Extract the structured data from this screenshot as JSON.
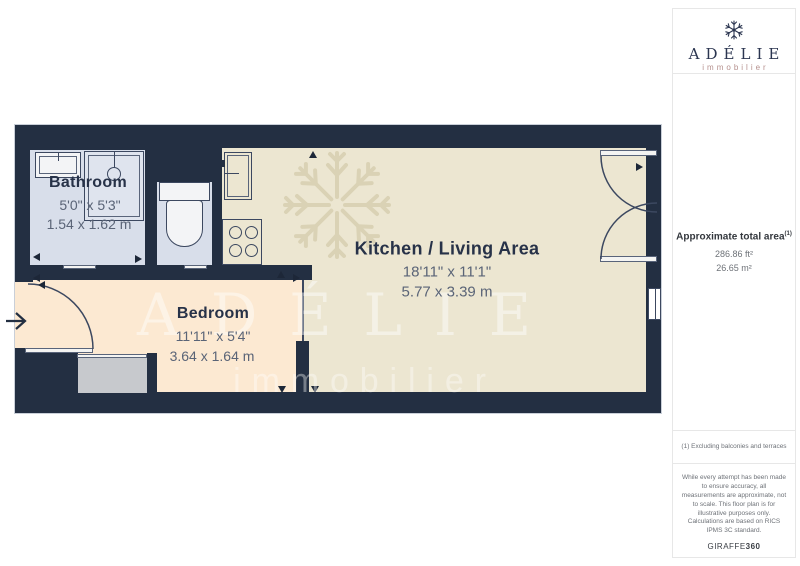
{
  "sidebar": {
    "brand": {
      "name": "ADÉLIE",
      "tagline": "immobilier"
    },
    "area": {
      "label": "Approximate total area",
      "footnote_marker": "(1)",
      "imperial": "286.86 ft²",
      "metric": "26.65 m²"
    },
    "footnote": "(1) Excluding balconies and terraces",
    "disclaimer_accuracy": "While every attempt has been made to ensure accuracy, all measurements are approximate, not to scale. This floor plan is for illustrative purposes only.",
    "disclaimer_standard": "Calculations are based on RICS IPMS 3C standard.",
    "provider": {
      "name": "GIRAFFE",
      "suffix": "360"
    }
  },
  "floorplan": {
    "watermark": {
      "title": "ADÉLIE",
      "subtitle": "immobilier"
    },
    "rooms": [
      {
        "name": "Bathroom",
        "imperial": "5'0\" x 5'3\"",
        "metric": "1.54 x 1.62 m"
      },
      {
        "name": "Bedroom",
        "imperial": "11'11\" x 5'4\"",
        "metric": "3.64 x 1.64 m"
      },
      {
        "name": "Kitchen / Living Area",
        "imperial": "18'11\" x 11'1\"",
        "metric": "5.77 x 3.39 m"
      }
    ],
    "colors": {
      "wall": "#232f42",
      "kitchen_floor": "#ece6d1",
      "bedroom_floor": "#fce9d2",
      "bathroom_floor": "#d8deea",
      "closet": "#c7c9cd",
      "brand_navy": "#2b3550",
      "brand_rose": "#b5908d"
    }
  }
}
